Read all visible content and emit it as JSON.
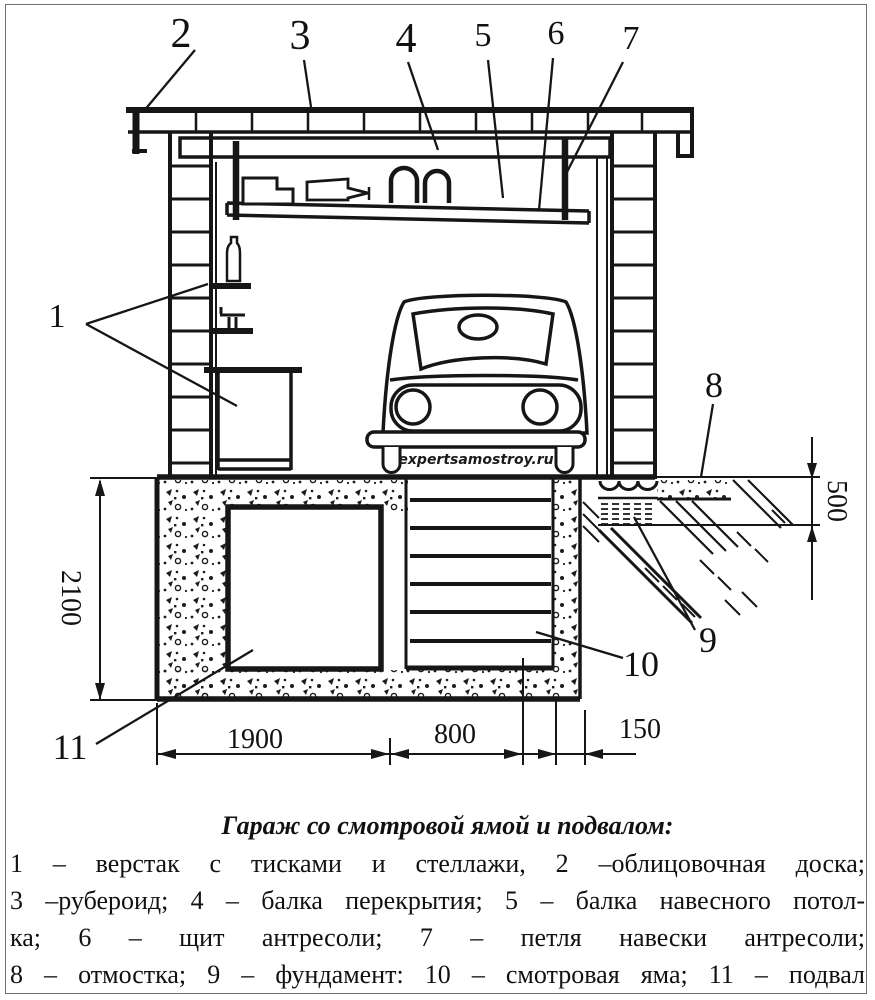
{
  "figure": {
    "callouts": [
      "1",
      "2",
      "3",
      "4",
      "5",
      "6",
      "7",
      "8",
      "9",
      "10",
      "11"
    ],
    "dims": {
      "height": "2100",
      "depth": "500",
      "w1": "1900",
      "w2": "800",
      "w3": "150"
    },
    "watermark": "expertsamostroy.ru",
    "ink_color": "#161616"
  },
  "caption": "Гараж со смотровой ямой и подвалом:",
  "legend": {
    "lines": [
      "1 – верстак с тисками и стеллажи, 2 –облицовочная доска;",
      "3 –рубероид; 4 – балка перекрытия; 5 – балка навесного потол-",
      "ка; 6 – щит антресоли; 7 – петля навески антресоли;",
      "8 – отмостка; 9 – фундамент: 10 – смотровая яма; 11 – подвал"
    ]
  }
}
